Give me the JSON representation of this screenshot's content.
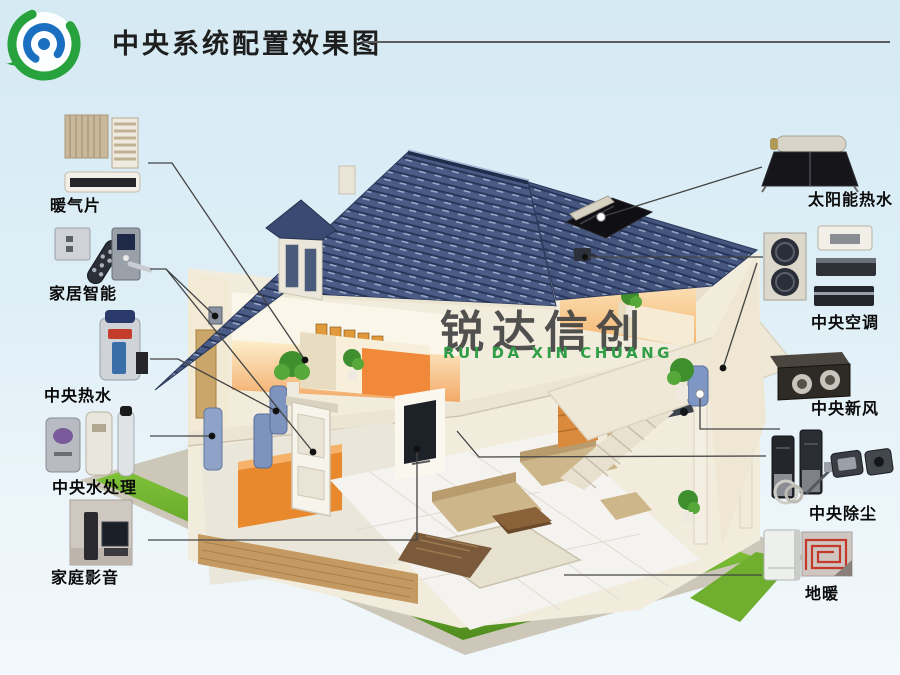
{
  "title": "中央系统配置效果图",
  "watermark": {
    "name": "锐达信创",
    "pinyin": "RUI DA XIN CHUANG",
    "logo_green": "#27a23c",
    "logo_blue": "#1b6fc0"
  },
  "colors": {
    "background_top": "#d6eaf4",
    "background_bottom": "#f2f8fb",
    "roof_tile": "#47587f",
    "lawn": "#6aa82c",
    "wall_cream": "#f2ecdd",
    "connector": "#444444",
    "label_text": "#0a0a0a"
  },
  "left_items": [
    {
      "label": "暖气片",
      "icon": "radiator-icon"
    },
    {
      "label": "家居智能",
      "icon": "smart-home-icon"
    },
    {
      "label": "中央热水",
      "icon": "water-heater-icon"
    },
    {
      "label": "中央水处理",
      "icon": "water-treatment-icon"
    },
    {
      "label": "家庭影音",
      "icon": "home-theater-icon"
    }
  ],
  "right_items": [
    {
      "label": "太阳能热水",
      "icon": "solar-water-heater-icon"
    },
    {
      "label": "中央空调",
      "icon": "central-ac-icon"
    },
    {
      "label": "中央新风",
      "icon": "fresh-air-icon"
    },
    {
      "label": "中央除尘",
      "icon": "central-vacuum-icon"
    },
    {
      "label": "地暖",
      "icon": "floor-heating-icon"
    }
  ]
}
